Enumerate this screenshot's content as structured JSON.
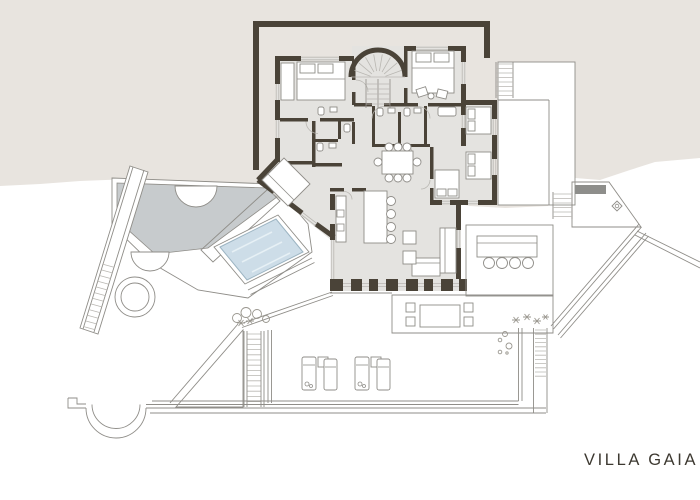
{
  "title": "VILLA GAIA",
  "palette": {
    "paper": "#ffffff",
    "terrain": "#e8e4df",
    "floor": "#e4e3e0",
    "wall": "#4a4338",
    "outline": "#8f8d88",
    "soft_line": "#b9b7b2",
    "pool_water": "#cddde8",
    "pool_edge": "#9cb4c2",
    "pool_terrace": "#c7cbcd",
    "deck": "#ddd7c8",
    "deck_stripe": "#b8af9a",
    "gravel": "#d9d5cd",
    "gravel_dot": "#a5a195",
    "bench": "#8e8e8b",
    "plant": "#9a978f",
    "text": "#3d3931"
  }
}
